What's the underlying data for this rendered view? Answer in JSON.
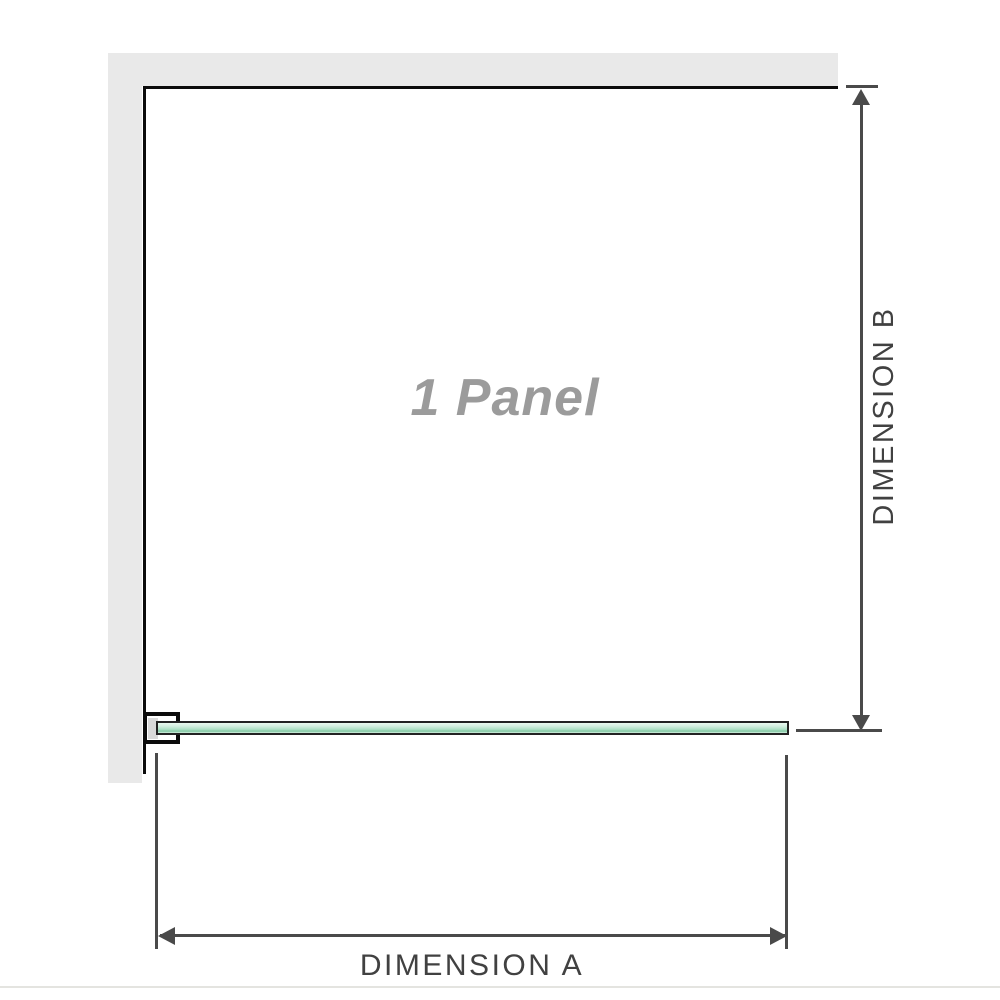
{
  "diagram": {
    "title": "1 Panel shower screen dimension diagram",
    "panel_label": "1 Panel",
    "dimension_a_label": "DIMENSION A",
    "dimension_b_label": "DIMENSION B"
  },
  "colors": {
    "wall": "#e9e9e9",
    "panel-border": "#0b0b0b",
    "dimension": "#4a4a4a",
    "label-text": "#414141",
    "panel-text": "#9b9b9b",
    "glass-border": "#222222",
    "glass-light": "#d5efe1",
    "glass-mid": "#abdfc3",
    "glass-dark": "#83c8a4"
  }
}
